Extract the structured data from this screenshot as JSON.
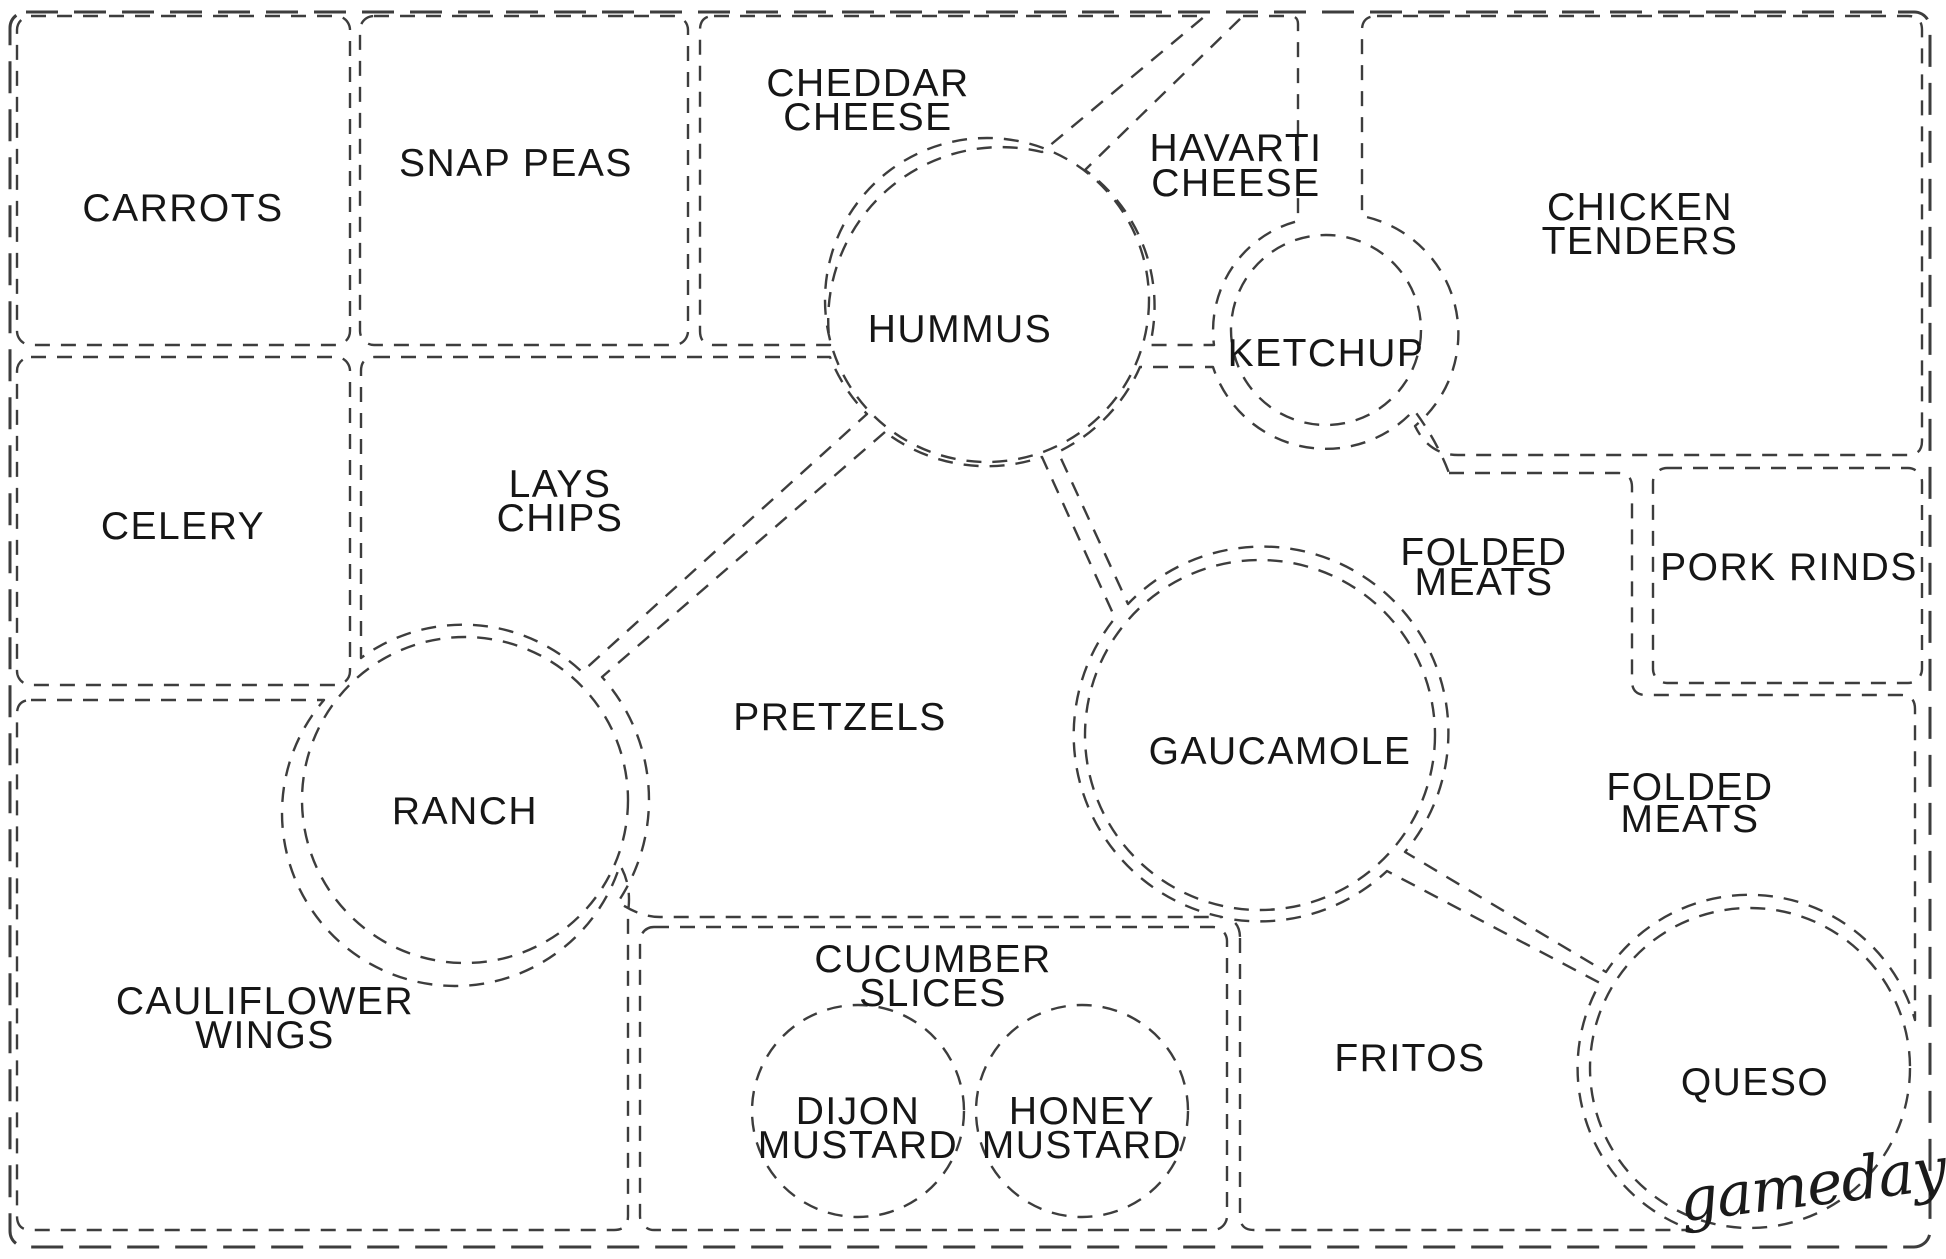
{
  "page": {
    "colors": {
      "background": "#ffffff",
      "line": "#3d3d3d",
      "text": "#161616"
    }
  },
  "labels": {
    "carrots": {
      "l1": "CARROTS"
    },
    "snap_peas": {
      "l1": "SNAP PEAS"
    },
    "cheddar_cheese": {
      "l1": "CHEDDAR",
      "l2": "CHEESE"
    },
    "havarti_cheese": {
      "l1": "HAVARTI",
      "l2": "CHEESE"
    },
    "chicken_tenders": {
      "l1": "CHICKEN",
      "l2": "TENDERS"
    },
    "hummus": {
      "l1": "HUMMUS"
    },
    "ketchup": {
      "l1": "KETCHUP"
    },
    "celery": {
      "l1": "CELERY"
    },
    "lays_chips": {
      "l1": "LAYS",
      "l2": "CHIPS"
    },
    "folded_meats_upper": {
      "l1": "FOLDED",
      "l2": "MEATS"
    },
    "pork_rinds": {
      "l1": "PORK RINDS"
    },
    "pretzels": {
      "l1": "PRETZELS"
    },
    "guacamole": {
      "l1": "GAUCAMOLE"
    },
    "ranch": {
      "l1": "RANCH"
    },
    "folded_meats_lower": {
      "l1": "FOLDED",
      "l2": "MEATS"
    },
    "cauliflower_wings": {
      "l1": "CAULIFLOWER",
      "l2": "WINGS"
    },
    "cucumber_slices": {
      "l1": "CUCUMBER",
      "l2": "SLICES"
    },
    "dijon_mustard": {
      "l1": "DIJON",
      "l2": "MUSTARD"
    },
    "honey_mustard": {
      "l1": "HONEY",
      "l2": "MUSTARD"
    },
    "fritos": {
      "l1": "FRITOS"
    },
    "queso": {
      "l1": "QUESO"
    }
  },
  "signature": {
    "text": "gameday"
  }
}
